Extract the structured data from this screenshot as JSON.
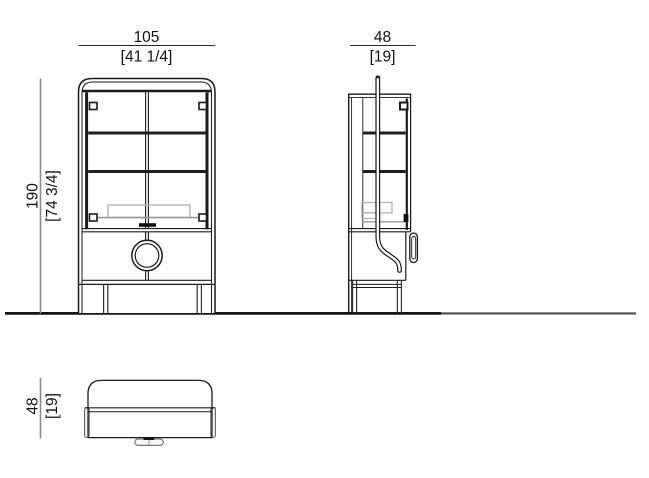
{
  "drawing_type": "furniture-technical-drawing",
  "views": {
    "front": {
      "width_dim": {
        "metric": "105",
        "imperial": "[41 1/4]"
      },
      "height_dim": {
        "metric": "190",
        "imperial": "[74 3/4]"
      }
    },
    "side": {
      "depth_dim": {
        "metric": "48",
        "imperial": "[19]"
      }
    },
    "top": {
      "depth_dim": {
        "metric": "48",
        "imperial": "[19]"
      }
    }
  },
  "colors": {
    "line": "#1a1a1a",
    "dimension_line": "#8a8a8a",
    "light_detail": "#b3b3b3",
    "background": "#ffffff"
  }
}
